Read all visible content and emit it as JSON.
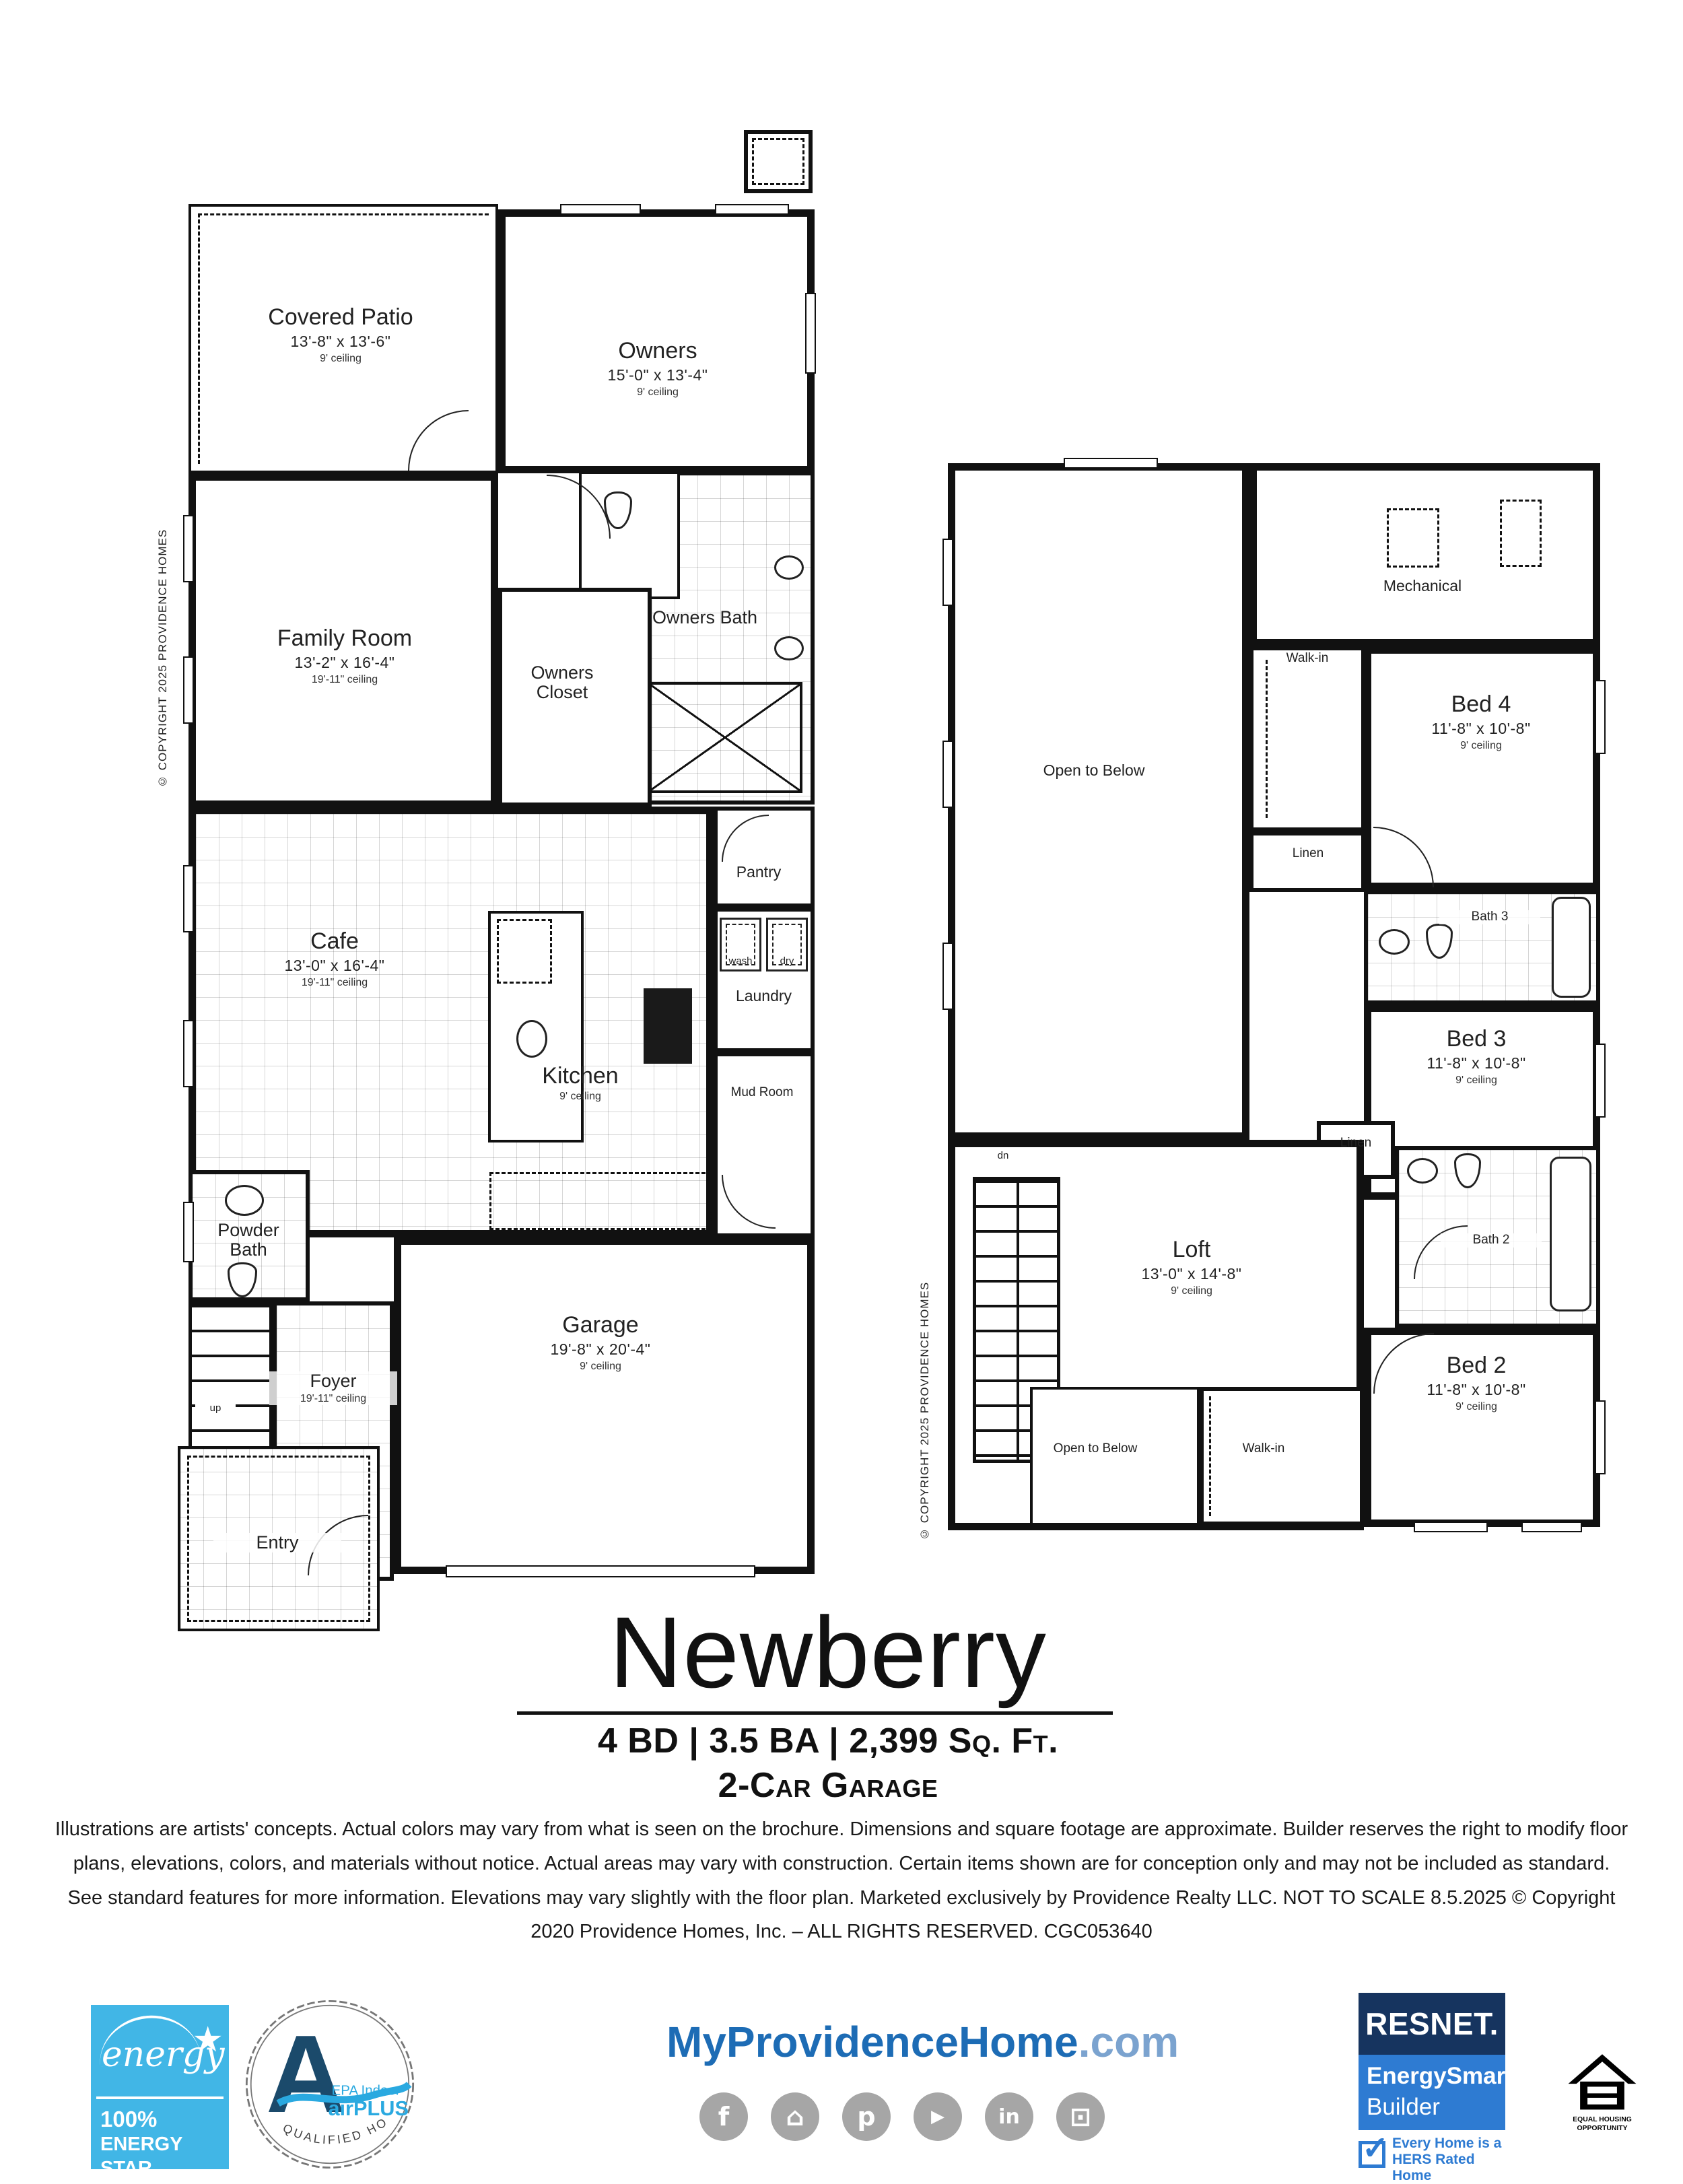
{
  "copyright_vertical": "© COPYRIGHT 2025 PROVIDENCE HOMES",
  "floor1": {
    "rooms": {
      "covered_patio": {
        "name": "Covered Patio",
        "dims": "13'-8\" x 13'-6\"",
        "ceiling": "9' ceiling"
      },
      "owners": {
        "name": "Owners",
        "dims": "15'-0\" x 13'-4\"",
        "ceiling": "9' ceiling"
      },
      "family_room": {
        "name": "Family Room",
        "dims": "13'-2\" x 16'-4\"",
        "ceiling": "19'-11\" ceiling"
      },
      "owners_bath": {
        "name": "Owners Bath"
      },
      "owners_closet": {
        "name": "Owners Closet"
      },
      "cafe": {
        "name": "Cafe",
        "dims": "13'-0\" x 16'-4\"",
        "ceiling": "19'-11\" ceiling"
      },
      "kitchen": {
        "name": "Kitchen",
        "ceiling": "9' ceiling"
      },
      "pantry": {
        "name": "Pantry"
      },
      "laundry": {
        "name": "Laundry",
        "washer": "wash",
        "dryer": "dry"
      },
      "mud_room": {
        "name": "Mud Room"
      },
      "powder_bath": {
        "name": "Powder Bath"
      },
      "garage": {
        "name": "Garage",
        "dims": "19'-8\" x 20'-4\"",
        "ceiling": "9' ceiling"
      },
      "foyer": {
        "name": "Foyer",
        "ceiling": "19'-11\" ceiling",
        "up_label": "up"
      },
      "entry": {
        "name": "Entry"
      }
    }
  },
  "floor2": {
    "rooms": {
      "open_to_below_top": {
        "name": "Open to Below"
      },
      "mechanical": {
        "name": "Mechanical"
      },
      "walk_in_1": {
        "name": "Walk-in"
      },
      "bed4": {
        "name": "Bed 4",
        "dims": "11'-8\" x 10'-8\"",
        "ceiling": "9' ceiling"
      },
      "linen_1": {
        "name": "Linen"
      },
      "bath3": {
        "name": "Bath 3"
      },
      "bed3": {
        "name": "Bed 3",
        "dims": "11'-8\" x 10'-8\"",
        "ceiling": "9' ceiling"
      },
      "linen_2": {
        "name": "Linen"
      },
      "bath2": {
        "name": "Bath 2"
      },
      "loft": {
        "name": "Loft",
        "dims": "13'-0\" x 14'-8\"",
        "ceiling": "9' ceiling"
      },
      "bed2": {
        "name": "Bed 2",
        "dims": "11'-8\" x 10'-8\"",
        "ceiling": "9' ceiling"
      },
      "walk_in_2": {
        "name": "Walk-in"
      },
      "open_to_below_bottom": {
        "name": "Open to Below"
      },
      "dn_label": "dn"
    }
  },
  "title_block": {
    "title": "Newberry",
    "specs_line1": "4 BD | 3.5 BA | 2,399 Sq. Ft.",
    "specs_line2": "2-Car Garage"
  },
  "disclaimer": "Illustrations are artists' concepts. Actual colors may vary from what is seen on the brochure. Dimensions and square footage are approximate. Builder reserves the right to modify floor plans, elevations, colors, and materials without notice.  Actual areas may vary with construction. Certain items shown are for conception only and may not be included as standard. See standard features for more information. Elevations may vary slightly with the floor plan. Marketed exclusively by Providence Realty LLC. NOT TO SCALE 8.5.2025 © Copyright 2020 Providence Homes, Inc. – ALL RIGHTS RESERVED. CGC053640",
  "footer": {
    "energy_star": {
      "script": "energy",
      "star": "★",
      "pct": "100%",
      "line1": "ENERGY STAR",
      "line2": "CERTIFIED"
    },
    "airplus": {
      "letter": "A",
      "line1": "EPA Indoor",
      "line2": "airPLUS",
      "arc_text": "QUALIFIED HOME"
    },
    "website": {
      "main": "MyProvidenceHome",
      "tld": ".com"
    },
    "social": [
      {
        "name": "facebook",
        "glyph": "f"
      },
      {
        "name": "houzz",
        "glyph": "⌂"
      },
      {
        "name": "pinterest",
        "glyph": "p"
      },
      {
        "name": "youtube",
        "glyph": "▶"
      },
      {
        "name": "linkedin",
        "glyph": "in"
      },
      {
        "name": "instagram",
        "glyph": "⊡"
      }
    ],
    "resnet": {
      "brand": "RESNET.",
      "sub1": "EnergySmart",
      "sub2": "Builder",
      "tag1": "Every Home is a",
      "tag2": "HERS Rated Home"
    },
    "equal_housing": {
      "line1": "EQUAL HOUSING",
      "line2": "OPPORTUNITY"
    }
  },
  "colors": {
    "energy_star_blue": "#41b6e6",
    "airplus_navy": "#1b4a6b",
    "airplus_blue": "#2aa9e0",
    "website_blue": "#1d6cb5",
    "resnet_navy": "#16345f",
    "resnet_blue": "#2e7bd2",
    "social_gray": "#a6a6a6"
  }
}
